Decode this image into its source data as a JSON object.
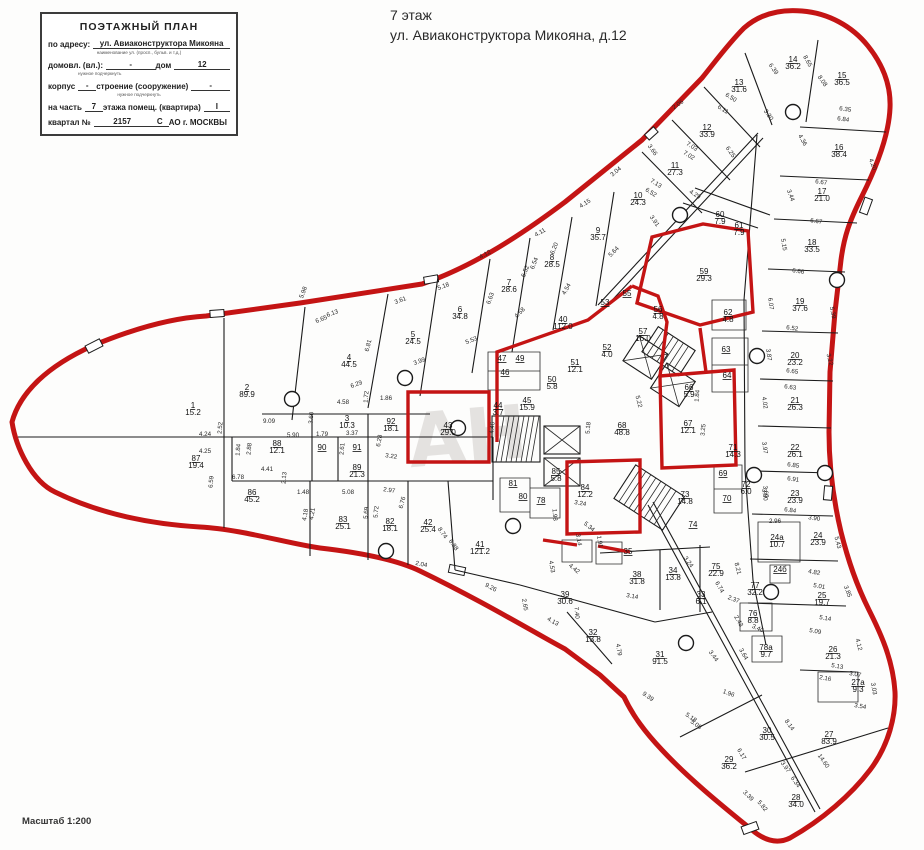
{
  "header": {
    "line1": "7 этаж",
    "line2": "ул. Авиаконструктора Микояна, д.12"
  },
  "stamp": {
    "title": "ПОЭТАЖНЫЙ ПЛАН",
    "address_label": "по адресу:",
    "address_value": "ул. Авиаконструктора Микояна",
    "address_note": "наименование ул. (просп., бульв. и т.д.)",
    "row2_label1": "домовл. (вл.):",
    "row2_value1": "-",
    "row2_label2": "дом",
    "row2_value2": "12",
    "row2_note": "нужное подчеркнуть",
    "row3_label1": "корпус",
    "row3_value1": "-",
    "row3_label2": "строение (сооружение)",
    "row3_value2": "-",
    "row3_note": "нужное подчеркнуть",
    "row4_label1": "на часть",
    "row4_value1": "7",
    "row4_label2": "этажа  помещ. (квартира)",
    "row4_value2": "I",
    "row5_label": "квартал №",
    "row5_value": "2157",
    "row5_letter": "С",
    "row5_suffix": "АО г. МОСКВЫ"
  },
  "scale_note": "Масштаб 1:200",
  "watermark": "АН",
  "colors": {
    "outline_red": "#c41414",
    "wall_black": "#1b1b1b"
  },
  "plan": {
    "rooms": [
      [
        "1",
        "15.2",
        193,
        408
      ],
      [
        "2",
        "89.9",
        247,
        390
      ],
      [
        "87",
        "19.4",
        196,
        461
      ],
      [
        "86",
        "45.2",
        252,
        495
      ],
      [
        "88",
        "12.1",
        277,
        446
      ],
      [
        "90",
        "",
        322,
        450
      ],
      [
        "91",
        "",
        357,
        450
      ],
      [
        "3",
        "10.3",
        347,
        421
      ],
      [
        "92",
        "18.1",
        391,
        424
      ],
      [
        "89",
        "21.3",
        357,
        470
      ],
      [
        "83",
        "25.1",
        343,
        522
      ],
      [
        "82",
        "18.1",
        390,
        524
      ],
      [
        "42",
        "25.4",
        428,
        525
      ],
      [
        "41",
        "121.2",
        480,
        547
      ],
      [
        "4",
        "44.5",
        349,
        360
      ],
      [
        "5",
        "24.5",
        413,
        337
      ],
      [
        "6",
        "34.8",
        460,
        312
      ],
      [
        "7",
        "28.6",
        509,
        285
      ],
      [
        "8",
        "28.5",
        552,
        260
      ],
      [
        "9",
        "35.7",
        598,
        233
      ],
      [
        "10",
        "24.3",
        638,
        198
      ],
      [
        "11",
        "27.3",
        675,
        168
      ],
      [
        "12",
        "33.9",
        707,
        130
      ],
      [
        "13",
        "31.6",
        739,
        85
      ],
      [
        "14",
        "36.2",
        793,
        62
      ],
      [
        "15",
        "36.5",
        842,
        78
      ],
      [
        "16",
        "38.4",
        839,
        150
      ],
      [
        "17",
        "21.0",
        822,
        194
      ],
      [
        "18",
        "33.5",
        812,
        245
      ],
      [
        "19",
        "37.6",
        800,
        304
      ],
      [
        "20",
        "23.2",
        795,
        358
      ],
      [
        "21",
        "26.3",
        795,
        403
      ],
      [
        "22",
        "26.1",
        795,
        450
      ],
      [
        "23",
        "23.9",
        795,
        496
      ],
      [
        "24а",
        "10.7",
        777,
        540
      ],
      [
        "24",
        "23.9",
        818,
        538
      ],
      [
        "24б",
        "",
        780,
        572
      ],
      [
        "25",
        "19.7",
        822,
        598
      ],
      [
        "26",
        "21.3",
        833,
        652
      ],
      [
        "27а",
        "9.3",
        858,
        685
      ],
      [
        "27",
        "83.9",
        829,
        737
      ],
      [
        "28",
        "34.0",
        796,
        800
      ],
      [
        "29",
        "36.2",
        729,
        762
      ],
      [
        "30",
        "30.5",
        767,
        733
      ],
      [
        "31",
        "91.5",
        660,
        657
      ],
      [
        "32",
        "13.8",
        593,
        635
      ],
      [
        "33",
        "6.1",
        701,
        597
      ],
      [
        "34",
        "13.8",
        673,
        573
      ],
      [
        "35",
        "",
        628,
        554
      ],
      [
        "38",
        "31.8",
        637,
        577
      ],
      [
        "39",
        "30.6",
        565,
        597
      ],
      [
        "40",
        "112.0",
        563,
        322
      ],
      [
        "43",
        "29.0",
        448,
        428
      ],
      [
        "44",
        "3.7",
        498,
        408
      ],
      [
        "45",
        "15.9",
        527,
        403
      ],
      [
        "46",
        "",
        505,
        375
      ],
      [
        "47",
        "",
        502,
        361
      ],
      [
        "49",
        "",
        520,
        361
      ],
      [
        "50",
        "5.8",
        552,
        382
      ],
      [
        "51",
        "12.1",
        575,
        365
      ],
      [
        "52",
        "4.0",
        607,
        350
      ],
      [
        "53",
        "",
        605,
        305
      ],
      [
        "55",
        "",
        627,
        296
      ],
      [
        "56",
        "4.8",
        658,
        312
      ],
      [
        "57",
        "16.0",
        643,
        334
      ],
      [
        "59",
        "29.3",
        704,
        274
      ],
      [
        "60",
        "7.9",
        720,
        217
      ],
      [
        "61",
        "7.9",
        739,
        228
      ],
      [
        "62",
        "4.8",
        728,
        315
      ],
      [
        "63",
        "",
        726,
        352
      ],
      [
        "64",
        "",
        727,
        378
      ],
      [
        "66",
        "5.9",
        689,
        390
      ],
      [
        "67",
        "12.1",
        688,
        426
      ],
      [
        "68",
        "48.8",
        622,
        428
      ],
      [
        "69",
        "",
        723,
        476
      ],
      [
        "70",
        "",
        727,
        501
      ],
      [
        "71",
        "14.3",
        733,
        450
      ],
      [
        "72",
        "6.0",
        746,
        487
      ],
      [
        "73",
        "14.8",
        685,
        497
      ],
      [
        "74",
        "",
        693,
        527
      ],
      [
        "75",
        "22.9",
        716,
        569
      ],
      [
        "76",
        "8.8",
        753,
        616
      ],
      [
        "77",
        "32.2",
        755,
        588
      ],
      [
        "78",
        "",
        541,
        503
      ],
      [
        "78а",
        "9.7",
        766,
        650
      ],
      [
        "80",
        "",
        523,
        499
      ],
      [
        "81",
        "",
        513,
        486
      ],
      [
        "84",
        "12.2",
        585,
        490
      ],
      [
        "85",
        "5.8",
        556,
        474
      ]
    ],
    "dims": [
      [
        "4.24",
        205,
        436,
        0
      ],
      [
        "4.25",
        205,
        453,
        0
      ],
      [
        "2.52",
        222,
        428,
        -85
      ],
      [
        "9.09",
        269,
        423,
        0
      ],
      [
        "5.90",
        293,
        437,
        0
      ],
      [
        "1.79",
        322,
        436,
        0
      ],
      [
        "3.37",
        352,
        435,
        0
      ],
      [
        "2.61",
        344,
        449,
        -85
      ],
      [
        "1.84",
        240,
        450,
        -85
      ],
      [
        "2.88",
        251,
        449,
        -85
      ],
      [
        "4.41",
        267,
        471,
        0
      ],
      [
        "2.13",
        286,
        478,
        -85
      ],
      [
        "1.48",
        303,
        494,
        0
      ],
      [
        "5.08",
        348,
        494,
        0
      ],
      [
        "6.78",
        238,
        479,
        0
      ],
      [
        "6.59",
        213,
        482,
        -85
      ],
      [
        "4.58",
        343,
        404,
        0
      ],
      [
        "3.60",
        313,
        418,
        -85
      ],
      [
        "1.72",
        368,
        397,
        -85
      ],
      [
        "6.29",
        357,
        386,
        -20
      ],
      [
        "1.86",
        386,
        400,
        0
      ],
      [
        "6.28",
        381,
        441,
        -80
      ],
      [
        "3.22",
        391,
        458,
        8
      ],
      [
        "2.97",
        389,
        492,
        8
      ],
      [
        "4.18",
        307,
        515,
        -80
      ],
      [
        "4.21",
        314,
        514,
        -80
      ],
      [
        "5.69",
        368,
        513,
        -85
      ],
      [
        "5.72",
        378,
        512,
        -85
      ],
      [
        "6.76",
        404,
        503,
        -75
      ],
      [
        "8.74",
        441,
        534,
        55
      ],
      [
        "6.88",
        452,
        546,
        55
      ],
      [
        "2.04",
        421,
        566,
        12
      ],
      [
        "4.46",
        494,
        428,
        -85
      ],
      [
        "5.98",
        305,
        293,
        -70
      ],
      [
        "6.65",
        322,
        321,
        -22
      ],
      [
        "6.13",
        333,
        315,
        -20
      ],
      [
        "3.61",
        401,
        302,
        -20
      ],
      [
        "5.18",
        444,
        288,
        -20
      ],
      [
        "6.81",
        370,
        346,
        -75
      ],
      [
        "3.99",
        420,
        363,
        -20
      ],
      [
        "5.53",
        472,
        342,
        -22
      ],
      [
        "6.63",
        492,
        299,
        -70
      ],
      [
        "4.58",
        521,
        314,
        -45
      ],
      [
        "6.54",
        536,
        264,
        -68
      ],
      [
        "6.20",
        556,
        249,
        -68
      ],
      [
        "4.11",
        541,
        234,
        -30
      ],
      [
        "4.12",
        486,
        256,
        -28
      ],
      [
        "4.15",
        586,
        205,
        -32
      ],
      [
        "3.04",
        617,
        173,
        -40
      ],
      [
        "6.52",
        527,
        272,
        -68
      ],
      [
        "5.64",
        615,
        253,
        -45
      ],
      [
        "4.54",
        568,
        290,
        -60
      ],
      [
        "6.39",
        772,
        70,
        55
      ],
      [
        "6.50",
        730,
        99,
        32
      ],
      [
        "6.11",
        722,
        111,
        32
      ],
      [
        "3.30",
        767,
        116,
        55
      ],
      [
        "2.06",
        679,
        106,
        -35
      ],
      [
        "7.03",
        691,
        148,
        32
      ],
      [
        "7.02",
        688,
        157,
        32
      ],
      [
        "6.25",
        729,
        153,
        55
      ],
      [
        "3.66",
        651,
        151,
        55
      ],
      [
        "7.13",
        655,
        185,
        32
      ],
      [
        "6.52",
        650,
        194,
        32
      ],
      [
        "4.29",
        694,
        196,
        32
      ],
      [
        "3.91",
        653,
        222,
        55
      ],
      [
        "8.65",
        806,
        62,
        60
      ],
      [
        "8.08",
        821,
        82,
        55
      ],
      [
        "6.35",
        845,
        111,
        8
      ],
      [
        "6.84",
        843,
        121,
        8
      ],
      [
        "4.36",
        801,
        141,
        60
      ],
      [
        "4.20",
        871,
        165,
        70
      ],
      [
        "6.67",
        821,
        184,
        8
      ],
      [
        "3.44",
        789,
        196,
        70
      ],
      [
        "6.67",
        816,
        223,
        8
      ],
      [
        "5.15",
        782,
        245,
        80
      ],
      [
        "6.66",
        798,
        273,
        8
      ],
      [
        "6.07",
        769,
        304,
        82
      ],
      [
        "5.39",
        831,
        313,
        78
      ],
      [
        "6.52",
        792,
        330,
        8
      ],
      [
        "3.87",
        767,
        355,
        82
      ],
      [
        "3.22",
        828,
        360,
        75
      ],
      [
        "6.65",
        792,
        373,
        8
      ],
      [
        "6.63",
        790,
        389,
        8
      ],
      [
        "4.02",
        763,
        403,
        82
      ],
      [
        "3.97",
        763,
        448,
        82
      ],
      [
        "6.85",
        793,
        467,
        8
      ],
      [
        "6.91",
        793,
        481,
        8
      ],
      [
        "3.60",
        764,
        492,
        82
      ],
      [
        "6.84",
        790,
        512,
        8
      ],
      [
        "2.96",
        775,
        523,
        0
      ],
      [
        "3.90",
        814,
        520,
        8
      ],
      [
        "5.43",
        836,
        543,
        75
      ],
      [
        "3.80",
        763,
        495,
        82
      ],
      [
        "3.25",
        705,
        430,
        -85
      ],
      [
        "1.84",
        699,
        396,
        -85
      ],
      [
        "5.22",
        637,
        402,
        75
      ],
      [
        "5.18",
        590,
        428,
        -85
      ],
      [
        "4.82",
        814,
        574,
        10
      ],
      [
        "5.01",
        819,
        588,
        10
      ],
      [
        "3.85",
        846,
        592,
        70
      ],
      [
        "5.14",
        825,
        620,
        10
      ],
      [
        "5.09",
        815,
        633,
        10
      ],
      [
        "4.12",
        857,
        645,
        75
      ],
      [
        "3.40",
        757,
        630,
        25
      ],
      [
        "5.13",
        837,
        668,
        10
      ],
      [
        "3.07",
        855,
        676,
        10
      ],
      [
        "2.16",
        825,
        680,
        10
      ],
      [
        "3.03",
        872,
        689,
        80
      ],
      [
        "3.54",
        860,
        708,
        10
      ],
      [
        "8.14",
        788,
        726,
        55
      ],
      [
        "14.60",
        822,
        762,
        55
      ],
      [
        "3.97",
        784,
        768,
        55
      ],
      [
        "6.34",
        794,
        783,
        55
      ],
      [
        "5.82",
        761,
        807,
        50
      ],
      [
        "3.39",
        747,
        797,
        45
      ],
      [
        "5.18",
        690,
        719,
        35
      ],
      [
        "5.08",
        695,
        726,
        35
      ],
      [
        "6.17",
        740,
        755,
        60
      ],
      [
        "9.39",
        647,
        698,
        35
      ],
      [
        "9.26",
        490,
        589,
        28
      ],
      [
        "1.96",
        728,
        695,
        20
      ],
      [
        "3.64",
        742,
        655,
        60
      ],
      [
        "3.44",
        712,
        657,
        55
      ],
      [
        "2.37",
        733,
        601,
        20
      ],
      [
        "2.43",
        737,
        622,
        60
      ],
      [
        "8.21",
        736,
        569,
        75
      ],
      [
        "6.74",
        718,
        588,
        60
      ],
      [
        "3.24",
        687,
        563,
        55
      ],
      [
        "3.14",
        632,
        598,
        10
      ],
      [
        "4.79",
        617,
        650,
        80
      ],
      [
        "7.40",
        575,
        613,
        85
      ],
      [
        "4.13",
        552,
        623,
        30
      ],
      [
        "2.65",
        523,
        605,
        80
      ],
      [
        "4.53",
        550,
        567,
        80
      ],
      [
        "4.42",
        573,
        570,
        40
      ],
      [
        "1.91",
        598,
        542,
        80
      ],
      [
        "3.14",
        577,
        540,
        80
      ],
      [
        "5.34",
        588,
        528,
        40
      ],
      [
        "1.98",
        553,
        515,
        85
      ],
      [
        "3.24",
        580,
        505,
        10
      ]
    ]
  }
}
